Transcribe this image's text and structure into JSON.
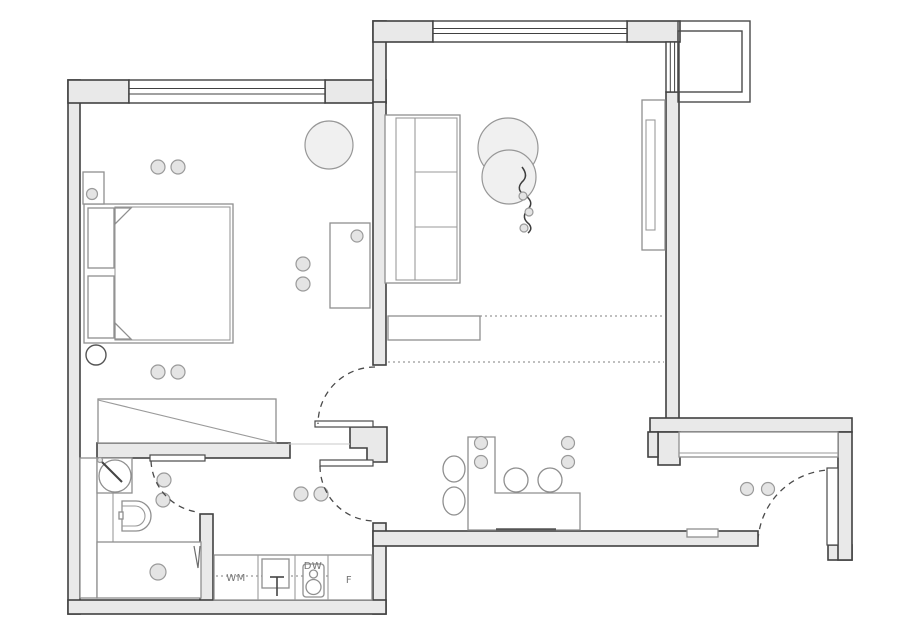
{
  "drawing": {
    "type": "apartment-floor-plan",
    "labels": {
      "washing_machine": "WM",
      "dishwasher": "DW",
      "fridge": "F"
    },
    "colors": {
      "background": "#ffffff",
      "wall_fill": "#e9e9e9",
      "wall_stroke": "#414141",
      "furniture_stroke": "#8f8f8f",
      "soft_fill": "#f0f0f0",
      "light_fixture_fill": "#e4e4e4",
      "label_color": "#767676"
    },
    "fixture_icons": [
      "bed-icon",
      "pillow-icon",
      "nightstand-icon",
      "wardrobe-icon",
      "desk-icon",
      "pouf-icon",
      "stool-icon",
      "sofa-icon",
      "hanging-chair-icon",
      "plant-vine-icon",
      "tall-cabinet-icon",
      "sideboard-icon",
      "washbasin-icon",
      "toilet-icon",
      "shower-icon",
      "kitchen-sink-icon",
      "hob-dishwasher-icon",
      "dining-table-icon",
      "chair-icon",
      "ceiling-light-icon",
      "entry-closet-icon",
      "doormat-icon",
      "door-swing-arc-icon",
      "window-icon",
      "balcony-icon"
    ]
  }
}
